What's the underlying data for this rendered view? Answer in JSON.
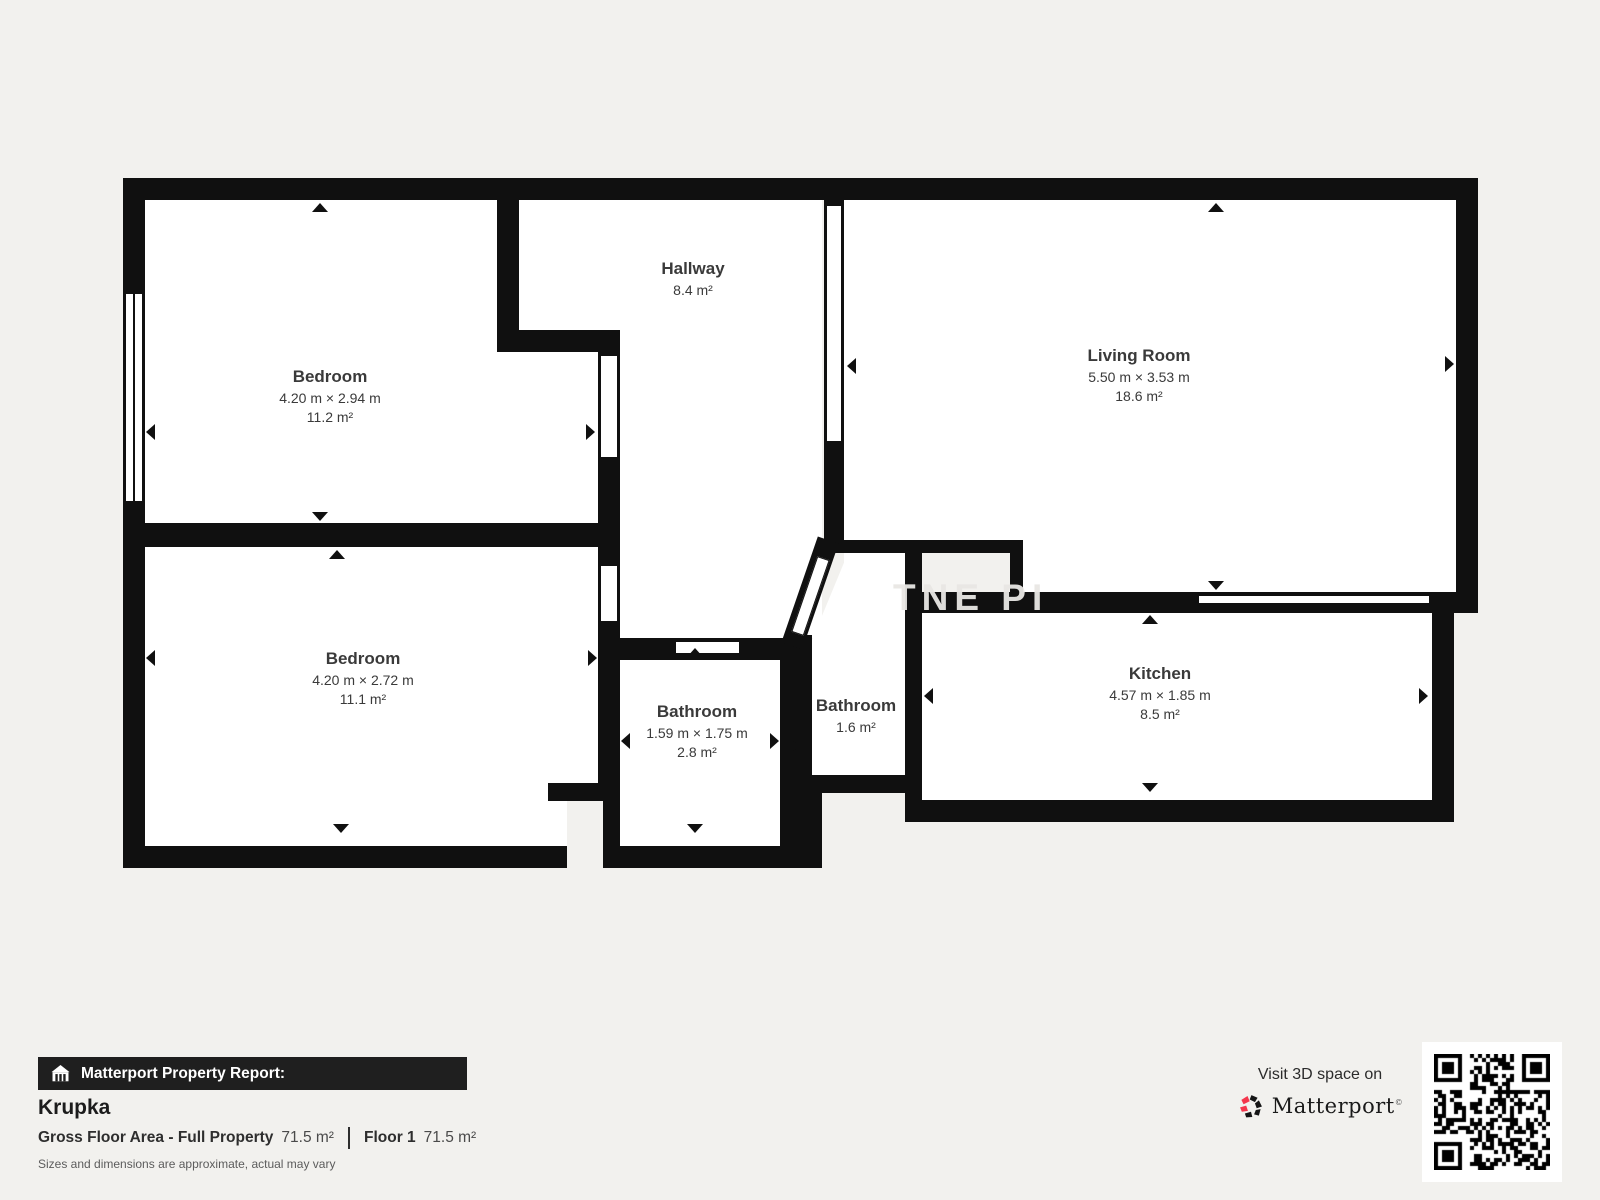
{
  "plan": {
    "watermark": "TNE PI",
    "rooms": [
      {
        "name": "Bedroom",
        "dimensions": "4.20 m × 2.94 m",
        "area": "11.2 m²"
      },
      {
        "name": "Bedroom",
        "dimensions": "4.20 m × 2.72 m",
        "area": "11.1 m²"
      },
      {
        "name": "Hallway",
        "dimensions": "",
        "area": "8.4 m²"
      },
      {
        "name": "Living Room",
        "dimensions": "5.50 m × 3.53 m",
        "area": "18.6 m²"
      },
      {
        "name": "Bathroom",
        "dimensions": "1.59 m × 1.75 m",
        "area": "2.8 m²"
      },
      {
        "name": "Bathroom",
        "dimensions": "",
        "area": "1.6 m²"
      },
      {
        "name": "Kitchen",
        "dimensions": "4.57 m × 1.85 m",
        "area": "8.5 m²"
      }
    ]
  },
  "report": {
    "banner": "Matterport Property Report:",
    "property_name": "Krupka",
    "gross_label": "Gross Floor Area - Full Property",
    "gross_value": "71.5 m²",
    "floor_label": "Floor 1",
    "floor_value": "71.5 m²",
    "disclaimer": "Sizes and dimensions are approximate, actual may vary"
  },
  "promo": {
    "visit_text": "Visit 3D space on",
    "brand": "Matterport",
    "trademark": "©"
  },
  "colors": {
    "wall": "#101010",
    "background": "#f2f1ee",
    "accent_pink": "#f4364c"
  }
}
